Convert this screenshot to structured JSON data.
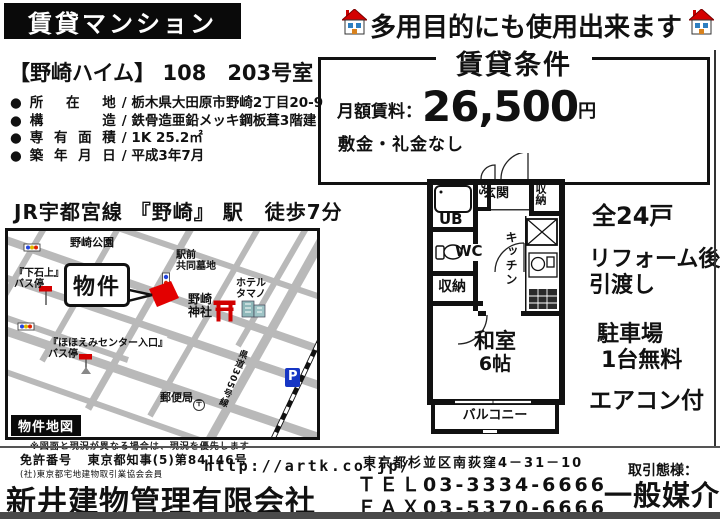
{
  "colors": {
    "accent_red": "#d40000",
    "road_gray": "#b9b9b9",
    "parking_blue": "#1636c4",
    "ink": "#111111"
  },
  "header": {
    "badge": "賃貸マンション",
    "tagline": "多用目的にも使用出来ます"
  },
  "property": {
    "bullet": "●",
    "slash": "/",
    "name": "【野崎ハイム】",
    "unit": "108　203号室",
    "details": [
      {
        "label": "所在地",
        "value": "栃木県大田原市野崎2丁目20-9"
      },
      {
        "label": "構造",
        "value": "鉄骨造亜鉛メッキ鋼板葺3階建"
      },
      {
        "label": "専有面積",
        "value": "1K 25.2㎡"
      },
      {
        "label": "築年月日",
        "value": "平成3年7月"
      }
    ],
    "access": "JR宇都宮線 『野崎』 駅　徒歩7分"
  },
  "terms": {
    "title": "賃貸条件",
    "rent_label": "月額賃料：",
    "rent_value": "26,500",
    "rent_unit": "円",
    "note": "敷金・礼金なし"
  },
  "map": {
    "legend": "物件地図",
    "callout": "物件",
    "park": "野崎公園",
    "bus1_line1": "『下石上』",
    "bus1_line2": "バス停",
    "cemetery_line1": "駅前",
    "cemetery_line2": "共同墓地",
    "hotel_line1": "ホテル",
    "hotel_line2": "タマノ",
    "shrine_line1": "野崎",
    "shrine_line2": "神社",
    "bus2_line1": "『ほほえみセンター入口』",
    "bus2_line2": "バス停",
    "post_office": "郵便局",
    "post_mark": "〒",
    "route": "県道305号線",
    "parking": "P",
    "disclaimer": "※図面と現況が異なる場合は、現況を優先します"
  },
  "floorplan": {
    "entrance": "玄関",
    "storage_top": "収納",
    "ps": "PS",
    "ub": "UB",
    "wc": "WC",
    "storage_mid": "収納",
    "kitchen": "キッチン",
    "room": "和室",
    "room_size": "6帖",
    "balcony": "バルコニー"
  },
  "features": [
    {
      "line1": "全24戸"
    },
    {
      "line1": "リフォーム後",
      "line2": "引渡し"
    },
    {
      "line1": "駐車場",
      "line2": "1台無料"
    },
    {
      "line1": "エアコン付"
    }
  ],
  "footer": {
    "license_label": "免許番号",
    "license_no": "東京都知事(5)第84146号",
    "association": "(社)東京都宅地建物取引業協会会員",
    "company": "新井建物管理有限会社",
    "url": "http://artk.co.jp/",
    "address": "東京都杉並区南荻窪4－31－10",
    "tel": "ＴＥＬ03-3334-6666",
    "fax": "ＦＡＸ03-5370-6666",
    "deal_label": "取引態様：",
    "deal_type": "一般媒介"
  }
}
